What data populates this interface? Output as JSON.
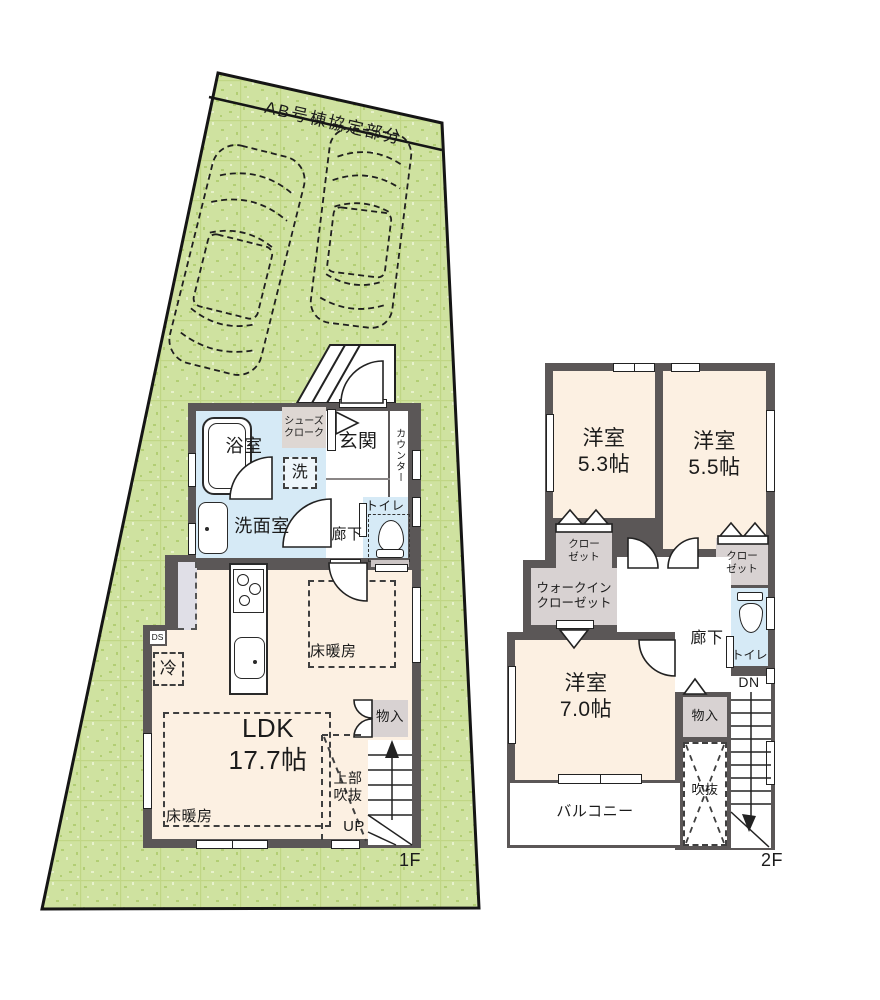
{
  "site": {
    "band_label": "AB号棟協定部分"
  },
  "floor1": {
    "floor_label": "1F",
    "bath": "浴室",
    "washroom": "洗面室",
    "laundry": "洗",
    "shoes_cloak": "シューズ\nクローク",
    "entrance": "玄関",
    "counter": "カウンター",
    "toilet": "トイレ",
    "hallway": "廊下",
    "ldk": "LDK\n17.7帖",
    "floor_heating_a": "床暖房",
    "floor_heating_b": "床暖房",
    "duct": "DS",
    "fridge": "冷",
    "storage": "物入",
    "void_above": "上部\n吹抜",
    "up": "UP"
  },
  "floor2": {
    "floor_label": "2F",
    "bedroom1": "洋室\n5.3帖",
    "bedroom2": "洋室\n5.5帖",
    "closet1": "クロー\nゼット",
    "closet2": "クロー\nゼット",
    "walk_in_closet": "ウォークイン\nクローゼット",
    "hallway": "廊下",
    "toilet": "トイレ",
    "bedroom3": "洋室\n7.0帖",
    "storage": "物入",
    "down": "DN",
    "void": "吹抜",
    "balcony": "バルコニー"
  }
}
